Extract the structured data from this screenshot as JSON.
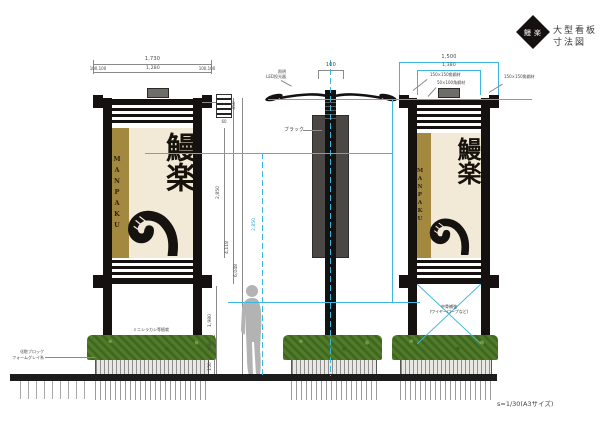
{
  "header": {
    "brand": "鰻楽",
    "title": "大型看板",
    "subtitle": "寸法図"
  },
  "scale_note": "s=1/30(A3サイズ)",
  "banner": {
    "roman": "MANPAKU",
    "kanji": "鰻楽"
  },
  "labels": {
    "lighting_line1": "照明",
    "lighting_line2": "LED投光器",
    "black": "ブラック",
    "planting": "ミニシラカシ等植栽",
    "block_line1": "化粧ブロック",
    "block_line2": "フォームグレイ系",
    "brace_line1": "中骨補強",
    "brace_line2": "(ワイヤーロープなど)",
    "steel_post": "150×150角鋼材",
    "steel_beam": "50×100角鋼材"
  },
  "dimensions": {
    "front": {
      "overall_width": "1,730",
      "panel_width": "1,280",
      "edge_left": "100,100",
      "edge_right": "100,100",
      "total_height": "6,048",
      "frame_height": "4,118",
      "panel_height": "2,850",
      "clearance": "1,980",
      "detail_height": "450",
      "detail_pitch": "60",
      "hedge_height": "400",
      "base_height": "150"
    },
    "side": {
      "pole_width": "100",
      "center_span": "2,850"
    },
    "back": {
      "outer_width": "1,500",
      "inner_width": "1,380"
    }
  },
  "colors": {
    "accent_cyan": "#3db8dc",
    "banner_gold": "#a3893f",
    "banner_cream": "#f2ead7",
    "frame_black": "#141110",
    "hedge_green": "#4e7c2a",
    "silhouette_gray": "#b3b3b3"
  }
}
